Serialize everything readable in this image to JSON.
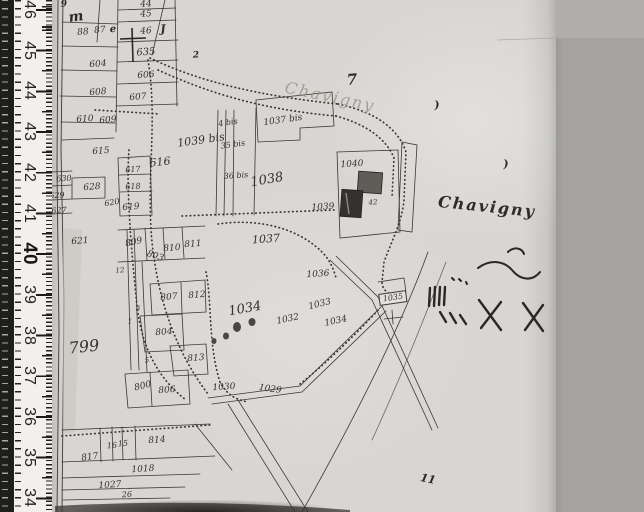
{
  "scene": {
    "kind": "scanned cadastral map with measuring ruler",
    "width": 644,
    "height": 512
  },
  "colors": {
    "bg_right": "#a4a3a1",
    "bg_right_top": "#b0afad",
    "paper": "#d8d6d2",
    "ruler_face": "#f2f0ec",
    "ruler_dark": "#1f1f1d",
    "ink": "#35322d",
    "ink_faint": "#97938b",
    "building_dark": "#34322f",
    "building_mid": "#605d59"
  },
  "ruler": {
    "unit_labels": [
      "46",
      "45",
      "44",
      "43",
      "42",
      "41",
      "40",
      "39",
      "38",
      "37",
      "36",
      "35",
      "34"
    ],
    "bold_label": "40",
    "start_y": 10,
    "step": 40.7
  },
  "map": {
    "place_names": [
      {
        "t": "Chavigny",
        "x": 330,
        "y": 97,
        "s": 16,
        "r": 12,
        "cls": "faint"
      },
      {
        "t": "Chavigny",
        "x": 487,
        "y": 207,
        "s": 16,
        "r": 6,
        "cls": "place"
      }
    ],
    "parcel_labels": [
      {
        "t": "44",
        "x": 146,
        "y": 5
      },
      {
        "t": "45",
        "x": 146,
        "y": 15
      },
      {
        "t": "46",
        "x": 146,
        "y": 32
      },
      {
        "t": "88",
        "x": 83,
        "y": 33
      },
      {
        "t": "87",
        "x": 100,
        "y": 31
      },
      {
        "t": "635",
        "x": 146,
        "y": 53,
        "s": 10
      },
      {
        "t": "604",
        "x": 98,
        "y": 65
      },
      {
        "t": "606",
        "x": 146,
        "y": 76
      },
      {
        "t": "608",
        "x": 98,
        "y": 93
      },
      {
        "t": "607",
        "x": 138,
        "y": 98
      },
      {
        "t": "610",
        "x": 85,
        "y": 120
      },
      {
        "t": "609",
        "x": 108,
        "y": 121
      },
      {
        "t": "615",
        "x": 101,
        "y": 152
      },
      {
        "t": "616",
        "x": 160,
        "y": 162,
        "s": 11,
        "r": -6
      },
      {
        "t": "1039 bis",
        "x": 201,
        "y": 140,
        "s": 11,
        "r": -8
      },
      {
        "t": "617",
        "x": 133,
        "y": 170,
        "s": 8
      },
      {
        "t": "618",
        "x": 133,
        "y": 187,
        "s": 8
      },
      {
        "t": "620",
        "x": 112,
        "y": 203,
        "s": 8,
        "r": -10
      },
      {
        "t": "619",
        "x": 131,
        "y": 208
      },
      {
        "t": "628",
        "x": 92,
        "y": 188
      },
      {
        "t": "630",
        "x": 64,
        "y": 179,
        "s": 8
      },
      {
        "t": "629",
        "x": 57,
        "y": 196,
        "s": 8
      },
      {
        "t": "627",
        "x": 59,
        "y": 211,
        "s": 8
      },
      {
        "t": "621",
        "x": 80,
        "y": 242
      },
      {
        "t": "809",
        "x": 134,
        "y": 243,
        "r": -12
      },
      {
        "t": "810",
        "x": 172,
        "y": 249
      },
      {
        "t": "811",
        "x": 193,
        "y": 245
      },
      {
        "t": "803",
        "x": 155,
        "y": 257,
        "r": 18
      },
      {
        "t": "807",
        "x": 169,
        "y": 298
      },
      {
        "t": "812",
        "x": 197,
        "y": 296
      },
      {
        "t": "804",
        "x": 164,
        "y": 333
      },
      {
        "t": "813",
        "x": 196,
        "y": 359
      },
      {
        "t": "799",
        "x": 84,
        "y": 347,
        "s": 16,
        "r": -6
      },
      {
        "t": "800",
        "x": 143,
        "y": 387,
        "r": -14
      },
      {
        "t": "806",
        "x": 167,
        "y": 391
      },
      {
        "t": "1030",
        "x": 224,
        "y": 388
      },
      {
        "t": "1029",
        "x": 270,
        "y": 390,
        "r": 8
      },
      {
        "t": "817",
        "x": 90,
        "y": 458,
        "r": -8
      },
      {
        "t": "16",
        "x": 112,
        "y": 446,
        "s": 8
      },
      {
        "t": "15",
        "x": 123,
        "y": 444,
        "s": 8
      },
      {
        "t": "814",
        "x": 157,
        "y": 441
      },
      {
        "t": "1018",
        "x": 143,
        "y": 470
      },
      {
        "t": "1027",
        "x": 110,
        "y": 486
      },
      {
        "t": "26",
        "x": 127,
        "y": 495,
        "s": 8
      },
      {
        "t": "1037",
        "x": 266,
        "y": 239,
        "s": 11
      },
      {
        "t": "1036",
        "x": 318,
        "y": 275
      },
      {
        "t": "1033",
        "x": 320,
        "y": 305,
        "r": -14
      },
      {
        "t": "1032",
        "x": 288,
        "y": 320,
        "r": -12
      },
      {
        "t": "1034",
        "x": 245,
        "y": 309,
        "s": 13,
        "r": -10
      },
      {
        "t": "1034",
        "x": 336,
        "y": 322,
        "r": -12
      },
      {
        "t": "1038",
        "x": 267,
        "y": 180,
        "s": 13,
        "r": -10
      },
      {
        "t": "1037 bis",
        "x": 283,
        "y": 121,
        "s": 9,
        "r": -8
      },
      {
        "t": "4 bis",
        "x": 228,
        "y": 123,
        "s": 8,
        "r": -8
      },
      {
        "t": "35 bis",
        "x": 233,
        "y": 145,
        "s": 8,
        "r": -8
      },
      {
        "t": "36 bis",
        "x": 236,
        "y": 176,
        "s": 8
      },
      {
        "t": "1040",
        "x": 352,
        "y": 165,
        "s": 9
      },
      {
        "t": "41",
        "x": 352,
        "y": 202,
        "s": 7
      },
      {
        "t": "42",
        "x": 373,
        "y": 203,
        "s": 7
      },
      {
        "t": "1039",
        "x": 323,
        "y": 208,
        "s": 9
      },
      {
        "t": "12",
        "x": 120,
        "y": 271,
        "s": 7
      },
      {
        "t": "3",
        "x": 138,
        "y": 309,
        "s": 7
      },
      {
        "t": "1",
        "x": 130,
        "y": 322,
        "s": 7
      },
      {
        "t": "5",
        "x": 147,
        "y": 361,
        "s": 7
      }
    ],
    "ink_marks": [
      {
        "t": "7",
        "x": 352,
        "y": 80,
        "s": 15,
        "cls": "mark"
      },
      {
        "t": "m",
        "x": 76,
        "y": 17,
        "s": 14,
        "r": -8,
        "cls": "mark"
      },
      {
        "t": "9",
        "x": 64,
        "y": 5,
        "s": 9,
        "cls": "mark"
      },
      {
        "t": "e",
        "x": 113,
        "y": 30,
        "s": 10,
        "cls": "mark"
      },
      {
        "t": "J",
        "x": 163,
        "y": 29,
        "s": 11,
        "cls": "mark"
      },
      {
        "t": "2",
        "x": 196,
        "y": 56,
        "s": 9,
        "cls": "mark"
      },
      {
        "t": ")",
        "x": 437,
        "y": 105,
        "s": 11,
        "cls": "mark"
      },
      {
        "t": ")",
        "x": 506,
        "y": 164,
        "s": 11,
        "cls": "mark"
      },
      {
        "t": "11",
        "x": 428,
        "y": 479,
        "s": 11,
        "r": 12,
        "cls": "mark"
      }
    ],
    "boxed_label": {
      "t": "1035",
      "x": 393,
      "y": 298,
      "s": 8,
      "r": -8,
      "cls": "boxed"
    }
  }
}
